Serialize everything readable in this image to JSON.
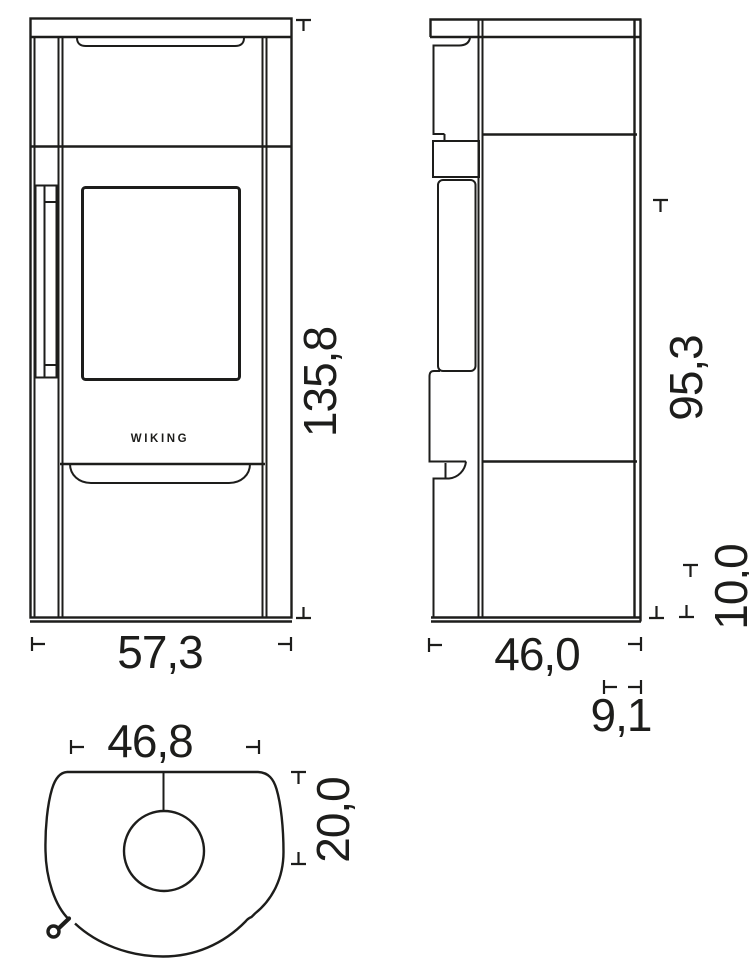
{
  "drawing": {
    "brand_label": "WIKING",
    "front_view": {
      "width_cm": "57,3",
      "height_cm": "135,8"
    },
    "side_view": {
      "depth_cm": "46,0",
      "rear_height_cm": "95,3",
      "base_height_cm": "10,0",
      "rear_offset_cm": "9,1"
    },
    "top_view": {
      "body_width_cm": "46,8",
      "flue_center_from_back_cm": "20,0"
    }
  }
}
